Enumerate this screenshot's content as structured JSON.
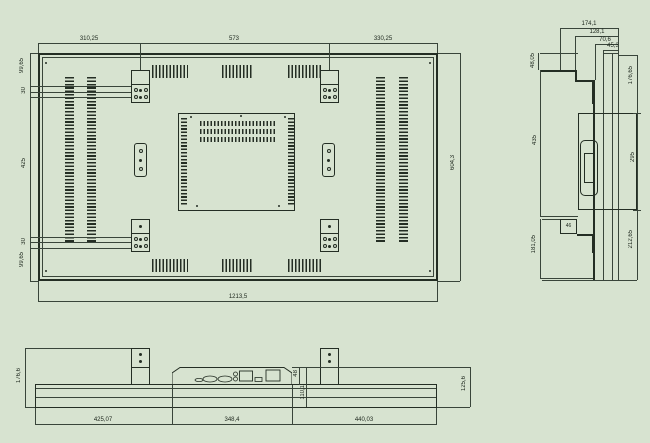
{
  "colors": {
    "background": "#d7e3d0",
    "line": "#242e24"
  },
  "rear": {
    "top_dims": [
      "310,25",
      "573",
      "330,25"
    ],
    "left_dims": [
      "99,65",
      "30",
      "425",
      "30",
      "99,65"
    ],
    "right_dim": "604,3",
    "bottom_dim": "1213,5"
  },
  "side": {
    "top_dims": [
      "174,1",
      "128,1",
      "70,6",
      "45,3"
    ],
    "left_dims": [
      "48,05",
      "435",
      "181,05"
    ],
    "right_dims": [
      "176,65",
      "295",
      "212,65"
    ],
    "step_dim": "46"
  },
  "bottom": {
    "left_dim": "176,6",
    "bottom_dims": [
      "425,07",
      "348,4",
      "440,03"
    ],
    "right_dim": "125,6",
    "recess_dims": [
      "48",
      "110,1"
    ],
    "ports": [
      "dc-jack",
      "vga-port",
      "vga-port",
      "audio-jacks",
      "lan-port",
      "usb-port",
      "power-inlet"
    ]
  }
}
